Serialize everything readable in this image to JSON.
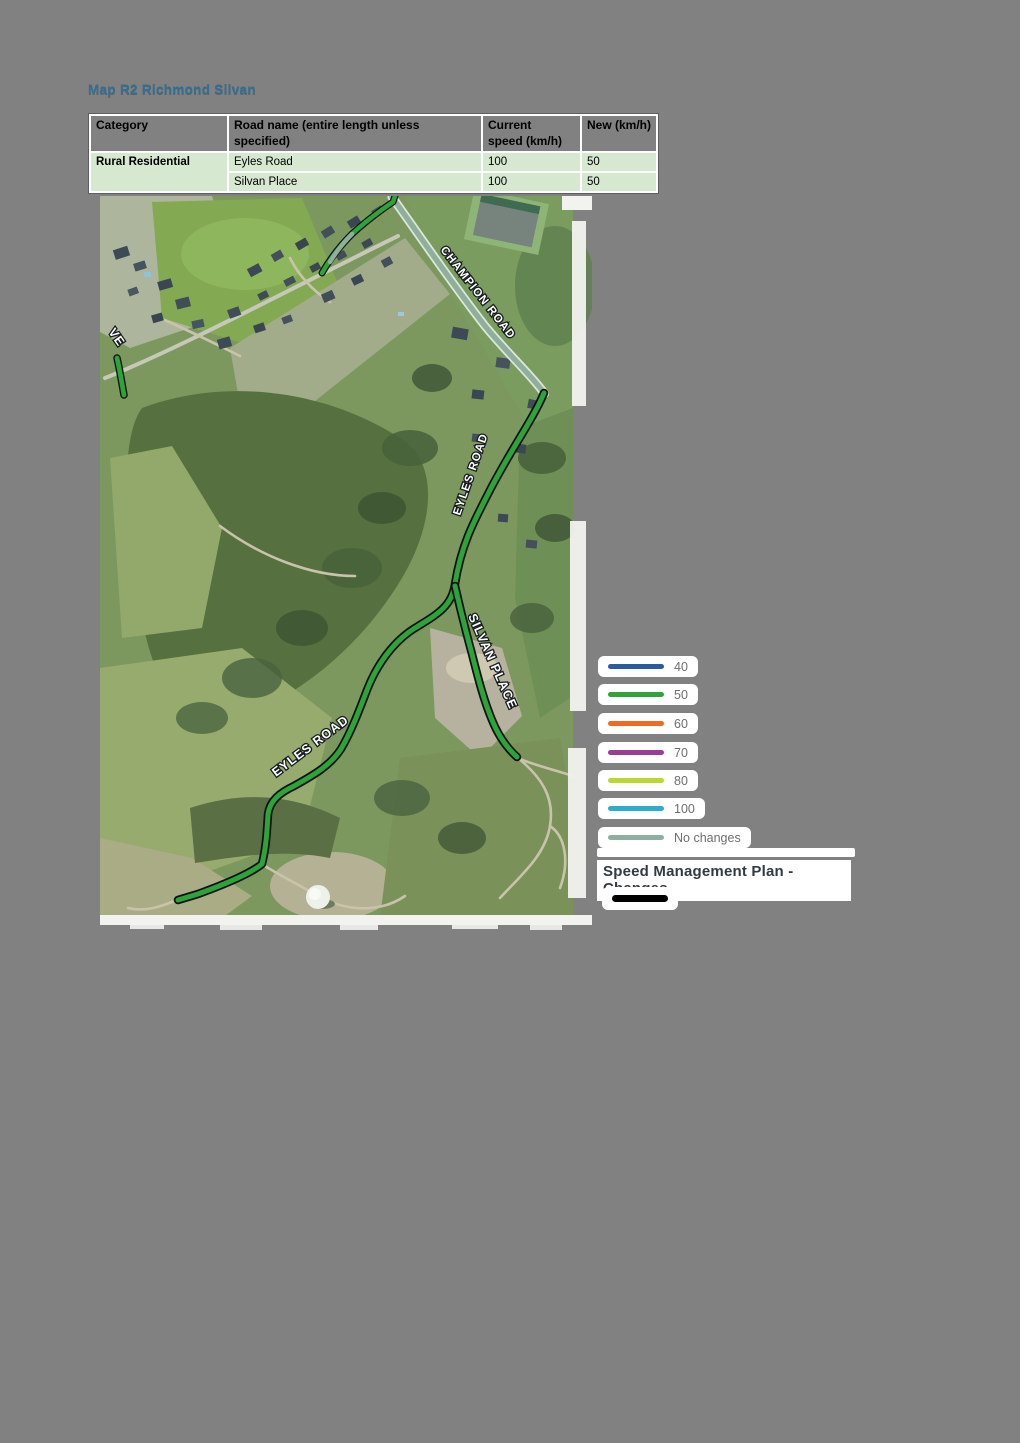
{
  "title": "Map R2 Richmond Silvan",
  "table": {
    "headers": {
      "category": "Category",
      "road_name": "Road name (entire length unless specified)",
      "current_speed": "Current speed (km/h)",
      "new_speed": "New (km/h)"
    },
    "category": "Rural Residential",
    "rows": [
      {
        "road": "Eyles Road",
        "current": "100",
        "new": "50"
      },
      {
        "road": "Silvan Place",
        "current": "100",
        "new": "50"
      }
    ]
  },
  "map": {
    "labels": {
      "champion_road": "CHAMPION ROAD",
      "eyles_road_upper": "EYLES ROAD",
      "eyles_road_lower": "EYLES ROAD",
      "silvan_place": "SILVAN PLACE",
      "drive_partial": "VE"
    }
  },
  "legend": {
    "items": [
      {
        "label": "40",
        "color": "#2B5AA5"
      },
      {
        "label": "50",
        "color": "#35A13C"
      },
      {
        "label": "60",
        "color": "#F06A21"
      },
      {
        "label": "70",
        "color": "#993E95"
      },
      {
        "label": "80",
        "color": "#BCD733"
      },
      {
        "label": "100",
        "color": "#2FABD0"
      },
      {
        "label": "No changes",
        "color": "#8FB0A0"
      }
    ],
    "plan_title": "Speed Management Plan - Changes",
    "changes_item_color": "#000000"
  },
  "colors": {
    "page_bg": "#818181",
    "title_text": "#336E93",
    "table_row_bg": "#D6E8CF",
    "road_changed": "#2EA23B",
    "road_unchanged": "#8FAE9C"
  }
}
